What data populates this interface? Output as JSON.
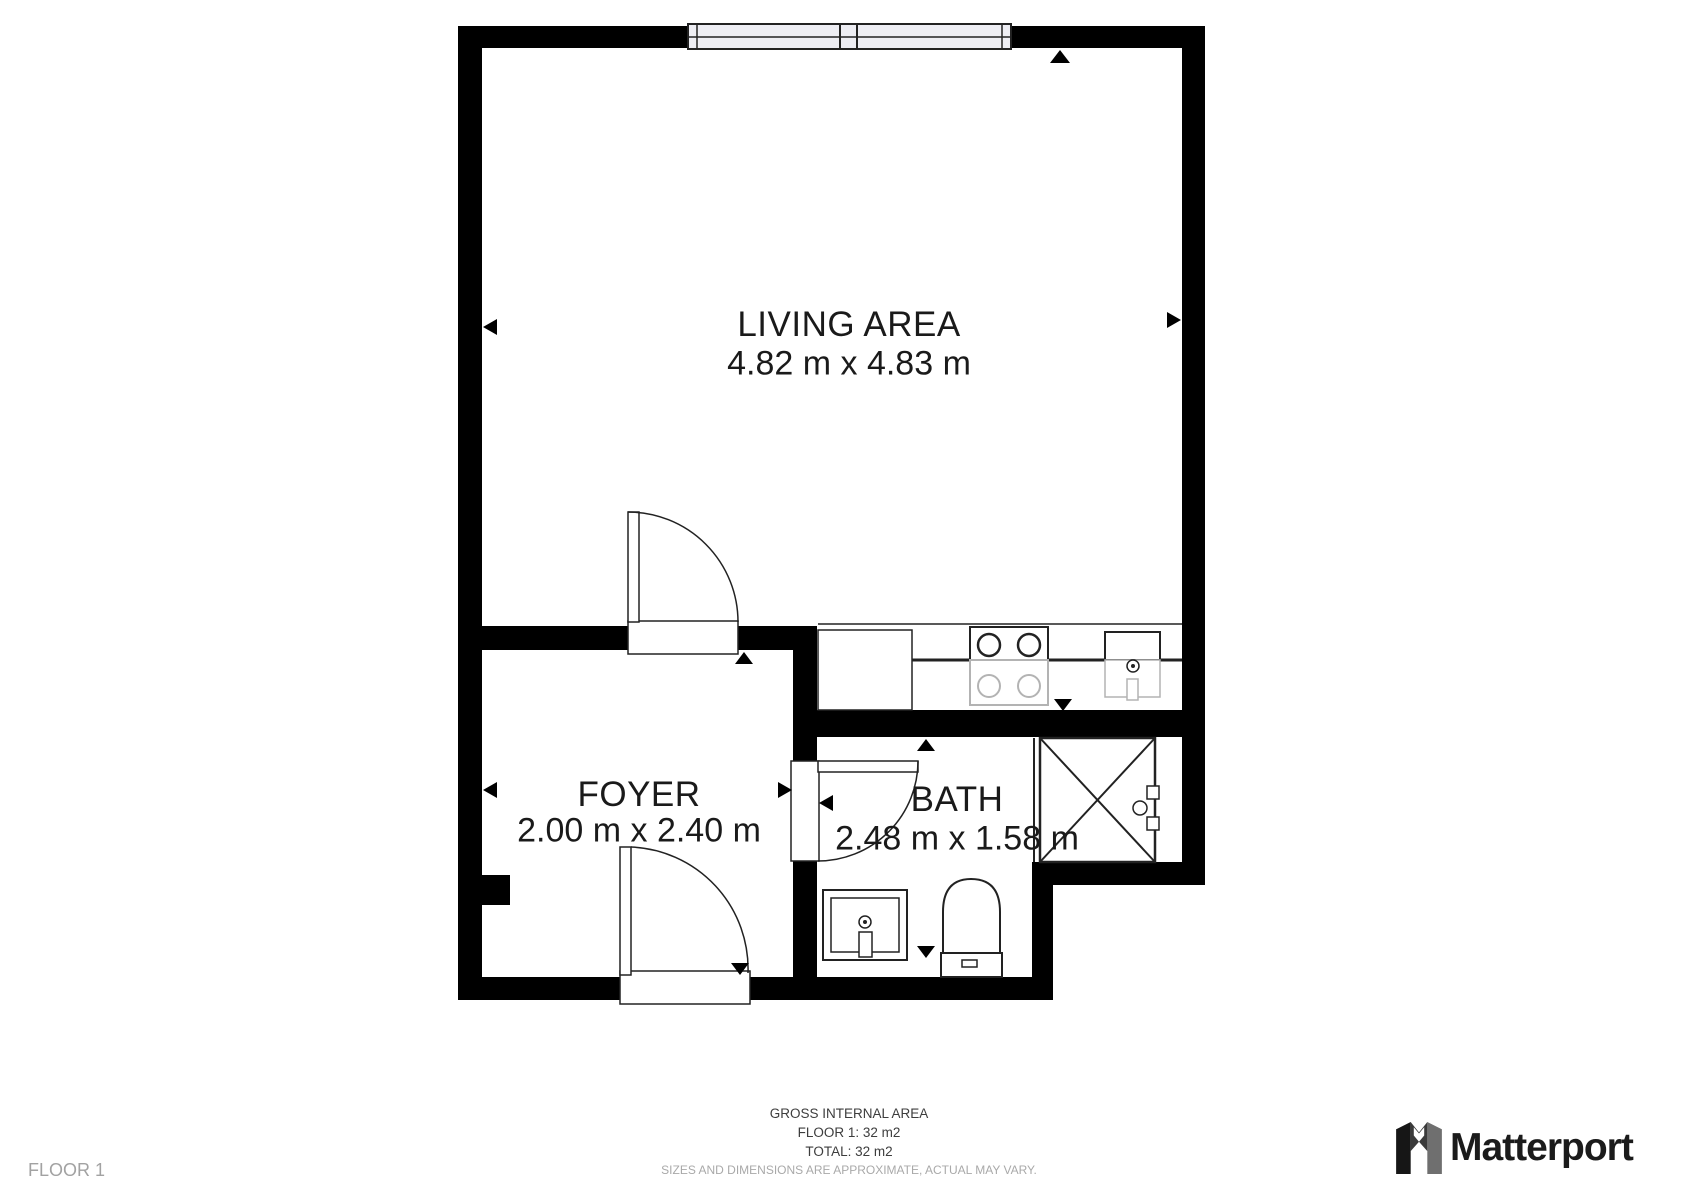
{
  "rooms": {
    "living": {
      "name": "LIVING AREA",
      "dims": "4.82 m x 4.83 m"
    },
    "foyer": {
      "name": "FOYER",
      "dims": "2.00 m x 2.40 m"
    },
    "bath": {
      "name": "BATH",
      "dims": "2.48 m x 1.58 m"
    }
  },
  "footer": {
    "title": "GROSS INTERNAL AREA",
    "floor_line": "FLOOR 1: 32 m2",
    "total_line": "TOTAL: 32 m2",
    "disclaimer": "SIZES AND DIMENSIONS ARE APPROXIMATE, ACTUAL MAY VARY."
  },
  "page": {
    "floor_label": "FLOOR 1",
    "brand": "Matterport"
  },
  "icons": [
    "window-icon",
    "door-swing-icon",
    "stove-icon",
    "kitchen-sink-icon",
    "shower-icon",
    "bath-sink-icon",
    "toilet-icon",
    "camera-marker-icon",
    "matterport-logo-icon"
  ],
  "colors": {
    "wall": "#000000",
    "line": "#222222",
    "ghost": "#b3b3b3",
    "window_fill": "#ededf3",
    "label_text": "#1a1a1a",
    "muted_text": "#a9a9a9",
    "brand_text": "#1b1b1b"
  }
}
